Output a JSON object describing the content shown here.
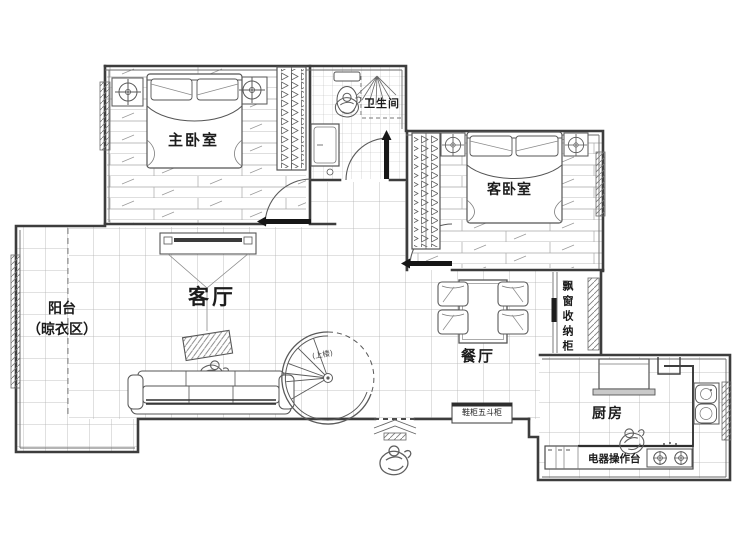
{
  "plan": {
    "rooms": {
      "master_bedroom": "主卧室",
      "bathroom": "卫生间",
      "guest_bedroom": "客卧室",
      "balcony_line1": "阳台",
      "balcony_line2": "（晾衣区）",
      "living_room": "客厅",
      "dining_room": "餐厅",
      "kitchen": "厨房"
    },
    "annotations": {
      "bay_window_cabinet": "飘窗收纳柜",
      "appliance_counter": "电器操作台",
      "shoe_cabinet": "鞋柜五斗柜",
      "stairs_up": "(上楼)"
    },
    "colors": {
      "background": "#ffffff",
      "wall": "#3d3d3d",
      "furniture_line": "#5a5a5a",
      "grid_line": "#b0b0b0",
      "text": "#1c1c1c",
      "door_leaf": "#161616"
    }
  }
}
